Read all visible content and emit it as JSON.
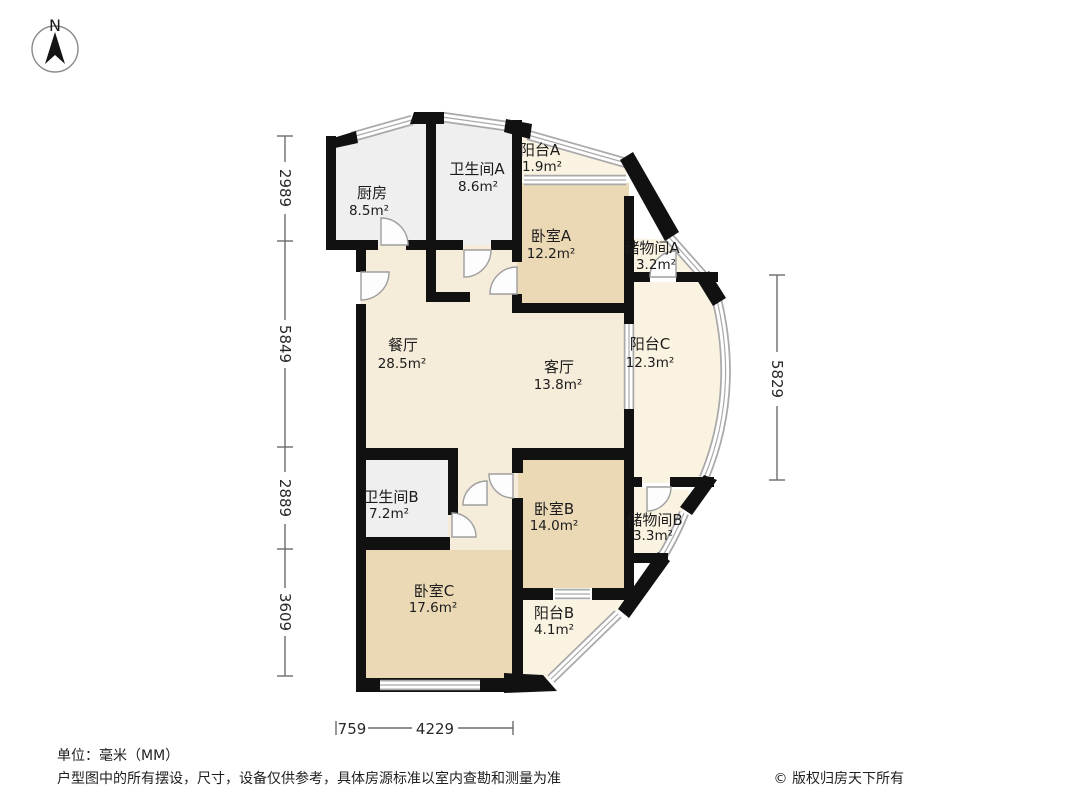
{
  "compass": {
    "north_label": "N"
  },
  "rooms": {
    "kitchen": {
      "name": "厨房",
      "area": "8.5m²"
    },
    "bathroom_a": {
      "name": "卫生间A",
      "area": "8.6m²"
    },
    "balcony_a": {
      "name": "阳台A",
      "area": "1.9m²"
    },
    "bedroom_a": {
      "name": "卧室A",
      "area": "12.2m²"
    },
    "storage_a": {
      "name": "储物间A",
      "area": "3.2m²"
    },
    "dining": {
      "name": "餐厅",
      "area": "28.5m²"
    },
    "living": {
      "name": "客厅",
      "area": "13.8m²"
    },
    "balcony_c": {
      "name": "阳台C",
      "area": "12.3m²"
    },
    "bathroom_b": {
      "name": "卫生间B",
      "area": "7.2m²"
    },
    "bedroom_b": {
      "name": "卧室B",
      "area": "14.0m²"
    },
    "storage_b": {
      "name": "储物间B",
      "area": "3.3m²"
    },
    "bedroom_c": {
      "name": "卧室C",
      "area": "17.6m²"
    },
    "balcony_b": {
      "name": "阳台B",
      "area": "4.1m²"
    }
  },
  "dimensions": {
    "left": [
      "2989",
      "5849",
      "2889",
      "3609"
    ],
    "right": [
      "5829"
    ],
    "bottom": [
      "759",
      "4229"
    ]
  },
  "footer": {
    "unit_note": "单位：毫米（MM）",
    "disclaimer": "户型图中的所有摆设，尺寸，设备仅供参考，具体房源标准以室内查勘和测量为准",
    "copyright": "© 版权归房天下所有"
  },
  "colors": {
    "wall": "#111111",
    "bedroom_fill": "#ebd9b6",
    "living_fill": "#f6ecda",
    "wet_fill": "#efefef",
    "balcony_fill": "#faf3e2",
    "window_line": "#a9a9a9",
    "dimension_line": "#6b6b6b"
  }
}
